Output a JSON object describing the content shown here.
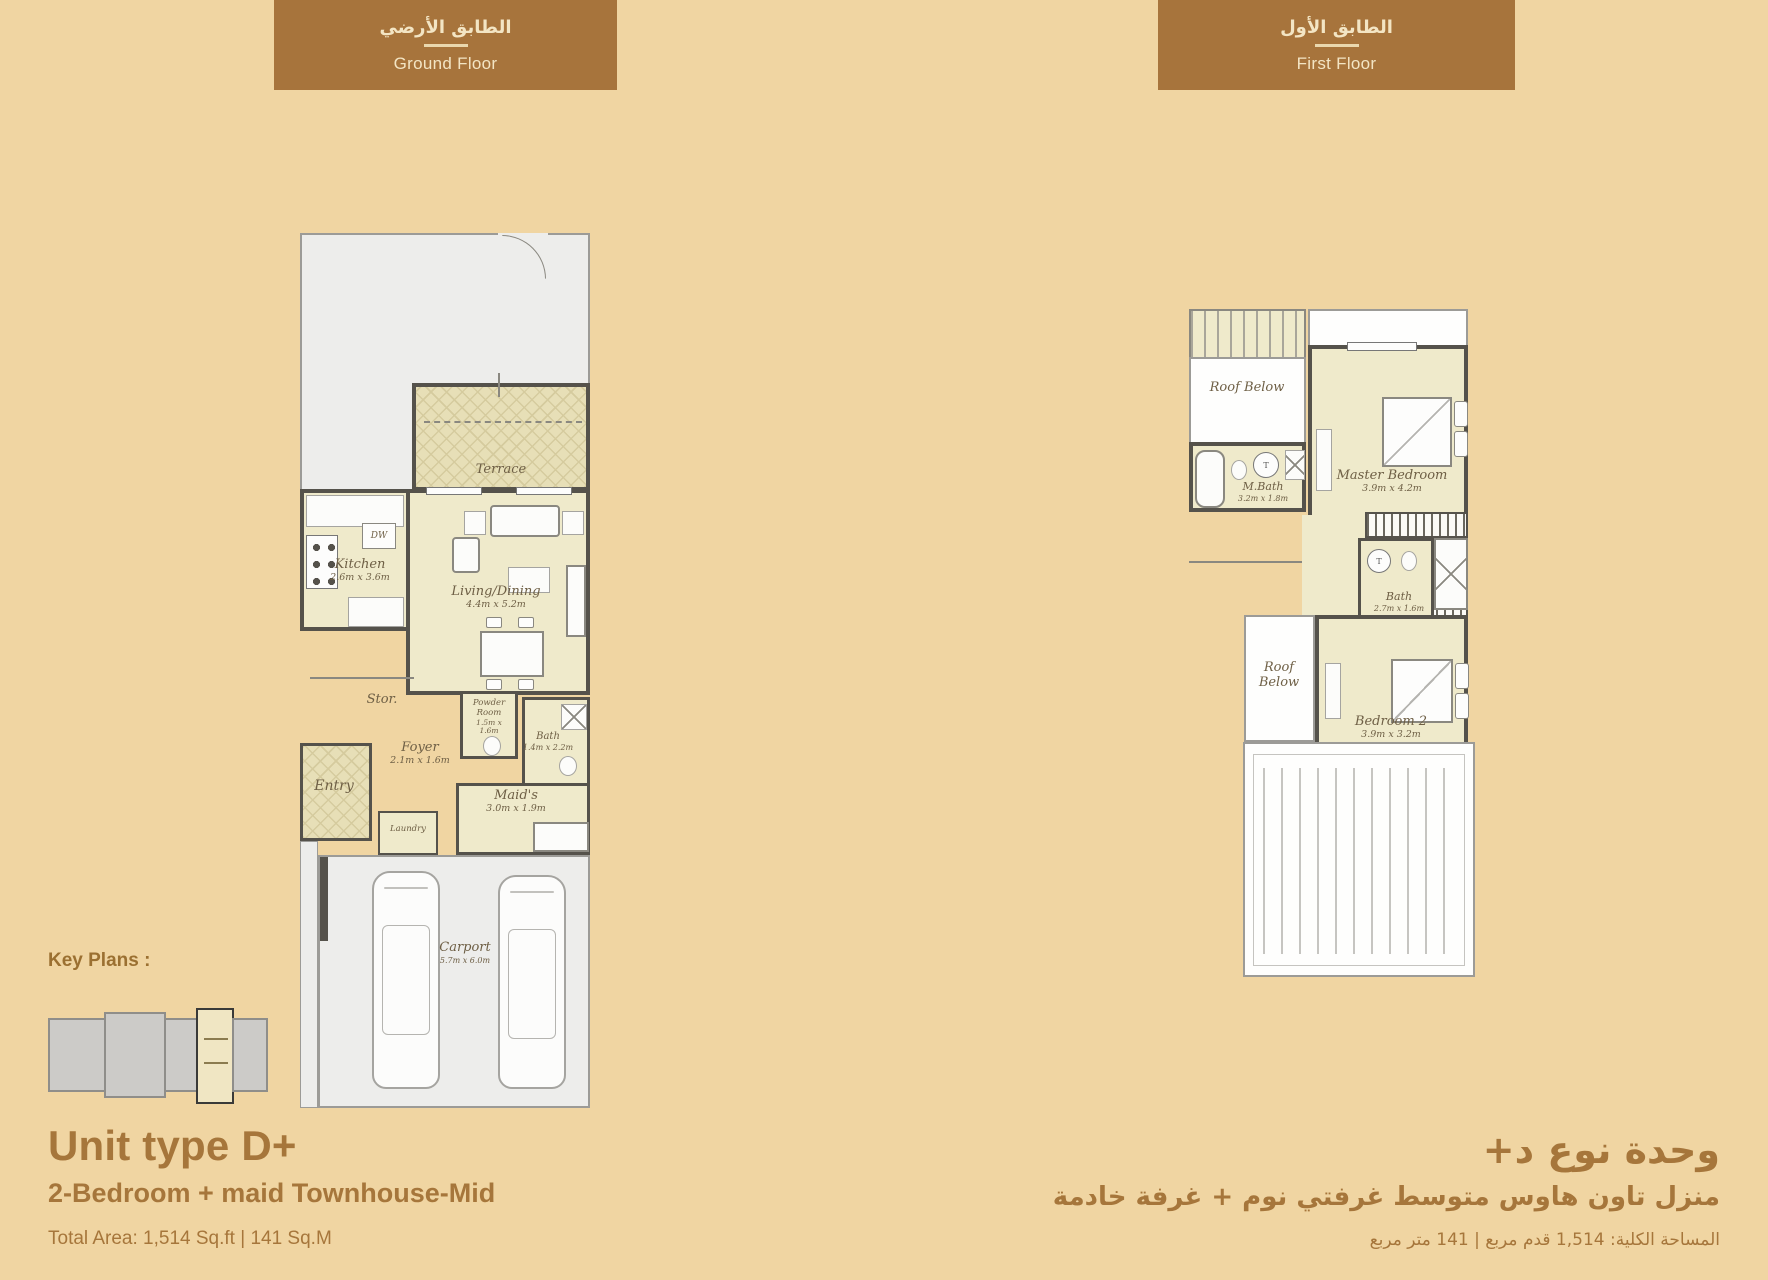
{
  "page": {
    "background": "#F0D5A2",
    "header_brown": "#A7743C",
    "header_text_color": "#F3E5C4",
    "title_brown": "#A6763B",
    "plan_room_fill": "#EFEACB",
    "plan_wall_color": "#55524B",
    "garden_grey": "#EDEDEB"
  },
  "floor_headers": {
    "ground": {
      "title_ar": "الطابق الأرضي",
      "title_en": "Ground Floor"
    },
    "first": {
      "title_ar": "الطابق الأول",
      "title_en": "First Floor"
    }
  },
  "key_plans": {
    "label": "Key Plans :"
  },
  "unit_info_en": {
    "title": "Unit type D+",
    "subtitle": "2-Bedroom + maid Townhouse-Mid",
    "total_area": "Total Area: 1,514 Sq.ft | 141 Sq.M"
  },
  "unit_info_ar": {
    "title": "وحدة نوع د+",
    "subtitle": "منزل تاون هاوس متوسط غرفتي نوم + غرفة خادمة",
    "total_area": "المساحة الكلية: 1,514 قدم مربع | 141 متر مربع"
  },
  "ground_floor": {
    "terrace": {
      "name": "Terrace"
    },
    "kitchen": {
      "name": "Kitchen",
      "dims": "2.6m x 3.6m"
    },
    "living_dining": {
      "name": "Living/Dining",
      "dims": "4.4m x 5.2m"
    },
    "store": {
      "name": "Stor."
    },
    "powder_room": {
      "name": "Powder Room",
      "dims": "1.5m x 1.6m"
    },
    "bath": {
      "name": "Bath",
      "dims": "1.4m x 2.2m"
    },
    "foyer": {
      "name": "Foyer",
      "dims": "2.1m x 1.6m"
    },
    "entry": {
      "name": "Entry"
    },
    "laundry": {
      "name": "Laundry"
    },
    "maids": {
      "name": "Maid's",
      "dims": "3.0m x 1.9m"
    },
    "carport": {
      "name": "Carport",
      "dims": "5.7m x 6.0m"
    },
    "dishwasher_label": "DW"
  },
  "first_floor": {
    "roof_below_1": {
      "name": "Roof Below"
    },
    "m_bath": {
      "name": "M.Bath",
      "dims": "3.2m x 1.8m"
    },
    "master_bedroom": {
      "name": "Master Bedroom",
      "dims": "3.9m x 4.2m"
    },
    "bath": {
      "name": "Bath",
      "dims": "2.7m x 1.6m"
    },
    "roof_below_2": {
      "name": "Roof Below"
    },
    "bedroom_2": {
      "name": "Bedroom 2",
      "dims": "3.9m x 3.2m"
    }
  }
}
